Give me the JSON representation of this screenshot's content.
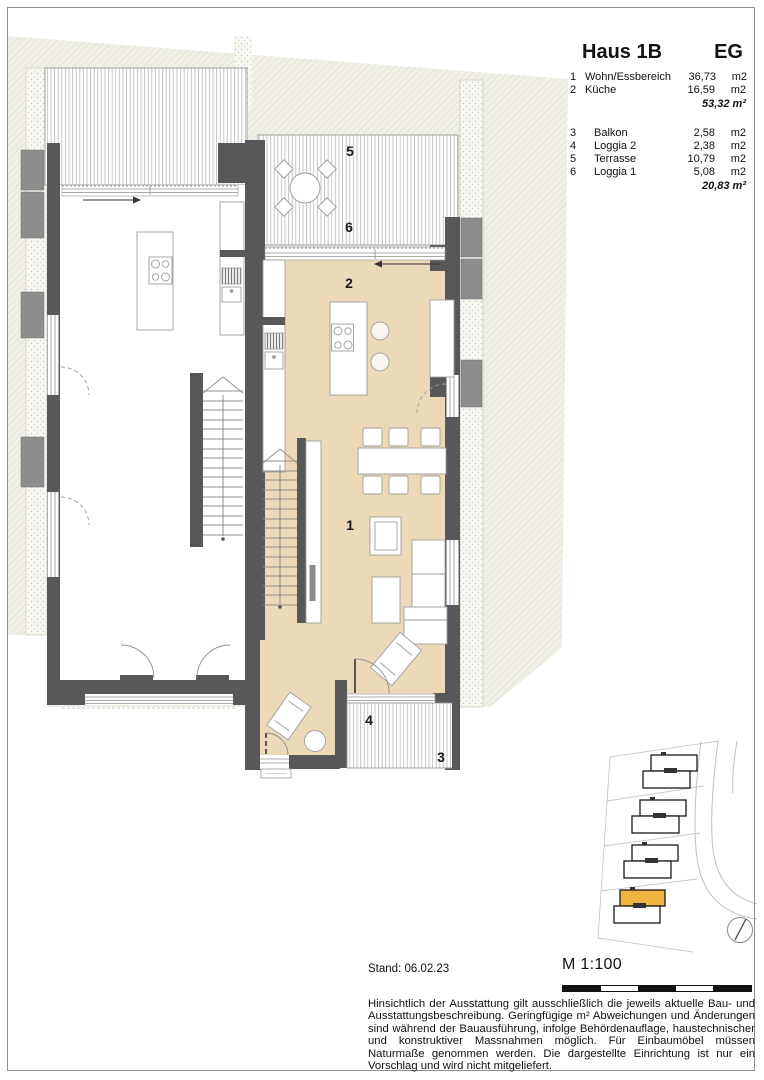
{
  "legend": {
    "title": "Haus 1B",
    "floor": "EG",
    "interior_rooms": [
      {
        "no": "1",
        "label": "Wohn/Essbereich",
        "value": "36,73",
        "unit": "m2"
      },
      {
        "no": "2",
        "label": "Küche",
        "value": "16,59",
        "unit": "m2"
      }
    ],
    "interior_total": "53,32 m²",
    "exterior_rooms": [
      {
        "no": "3",
        "label": "Balkon",
        "value": "2,58",
        "unit": "m2"
      },
      {
        "no": "4",
        "label": "Loggia 2",
        "value": "2,38",
        "unit": "m2"
      },
      {
        "no": "5",
        "label": "Terrasse",
        "value": "10,79",
        "unit": "m2"
      },
      {
        "no": "6",
        "label": "Loggia 1",
        "value": "5,08",
        "unit": "m2"
      }
    ],
    "exterior_total": "20,83 m²"
  },
  "plan": {
    "labels": {
      "wohnen": "1",
      "kueche": "2",
      "balkon": "3",
      "loggia2": "4",
      "terrasse": "5",
      "loggia1": "6"
    },
    "colors": {
      "floor_highlight": "#ecd9b8",
      "wall": "#58585a"
    }
  },
  "site_plan": {
    "highlight_color": "#f0b441"
  },
  "footer": {
    "stand": "Stand: 06.02.23",
    "scale_label": "M 1:100",
    "disclaimer": "Hinsichtlich der Ausstattung gilt ausschließlich die jeweils aktuelle Bau- und Ausstattungsbeschreibung. Geringfügige m² Abweichungen und Änderungen sind während der Bauausführung, infolge Behördenauflage, haustechnischer und konstruktiver Massnahmen möglich. Für Einbaumöbel müssen Naturmaße genommen werden. Die dargestellte Einrichtung ist nur ein Vorschlag und wird nicht mitgeliefert."
  }
}
